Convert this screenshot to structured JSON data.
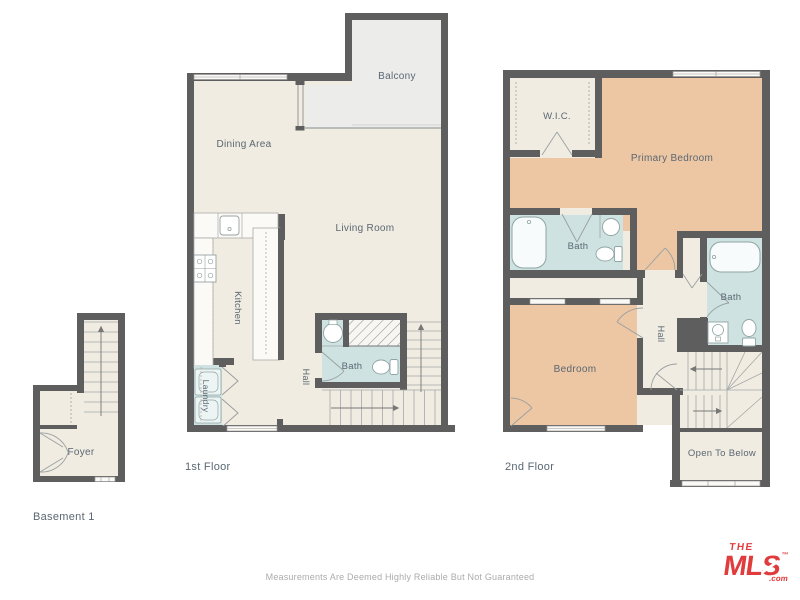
{
  "colors": {
    "floor_fill": "#F1ECE2",
    "bedroom_fill": "#EDC7A4",
    "bath_fill": "#CDE2E1",
    "balcony_fill": "#ECECEA",
    "wall": "#5E5E5E",
    "label_text": "#5A6772",
    "disclaimer_text": "#ABABAB",
    "logo_red": "#E03B3D"
  },
  "floors": {
    "basement": {
      "label": "Basement 1",
      "rooms": {
        "foyer": "Foyer"
      }
    },
    "first": {
      "label": "1st Floor",
      "rooms": {
        "balcony": "Balcony",
        "dining_area": "Dining Area",
        "living_room": "Living Room",
        "kitchen": "Kitchen",
        "laundry": "Laundry",
        "hall": "Hall",
        "bath": "Bath"
      }
    },
    "second": {
      "label": "2nd Floor",
      "rooms": {
        "wic": "W.I.C.",
        "primary_bedroom": "Primary Bedroom",
        "primary_bath": "Bath",
        "bath": "Bath",
        "hall": "Hall",
        "bedroom": "Bedroom",
        "open_to_below": "Open To Below"
      }
    }
  },
  "footer": {
    "disclaimer": "Measurements Are Deemed Highly Reliable But Not Guaranteed"
  },
  "logo": {
    "the": "THE",
    "mls": "MLS",
    "com": ".com",
    "tm": "™"
  }
}
